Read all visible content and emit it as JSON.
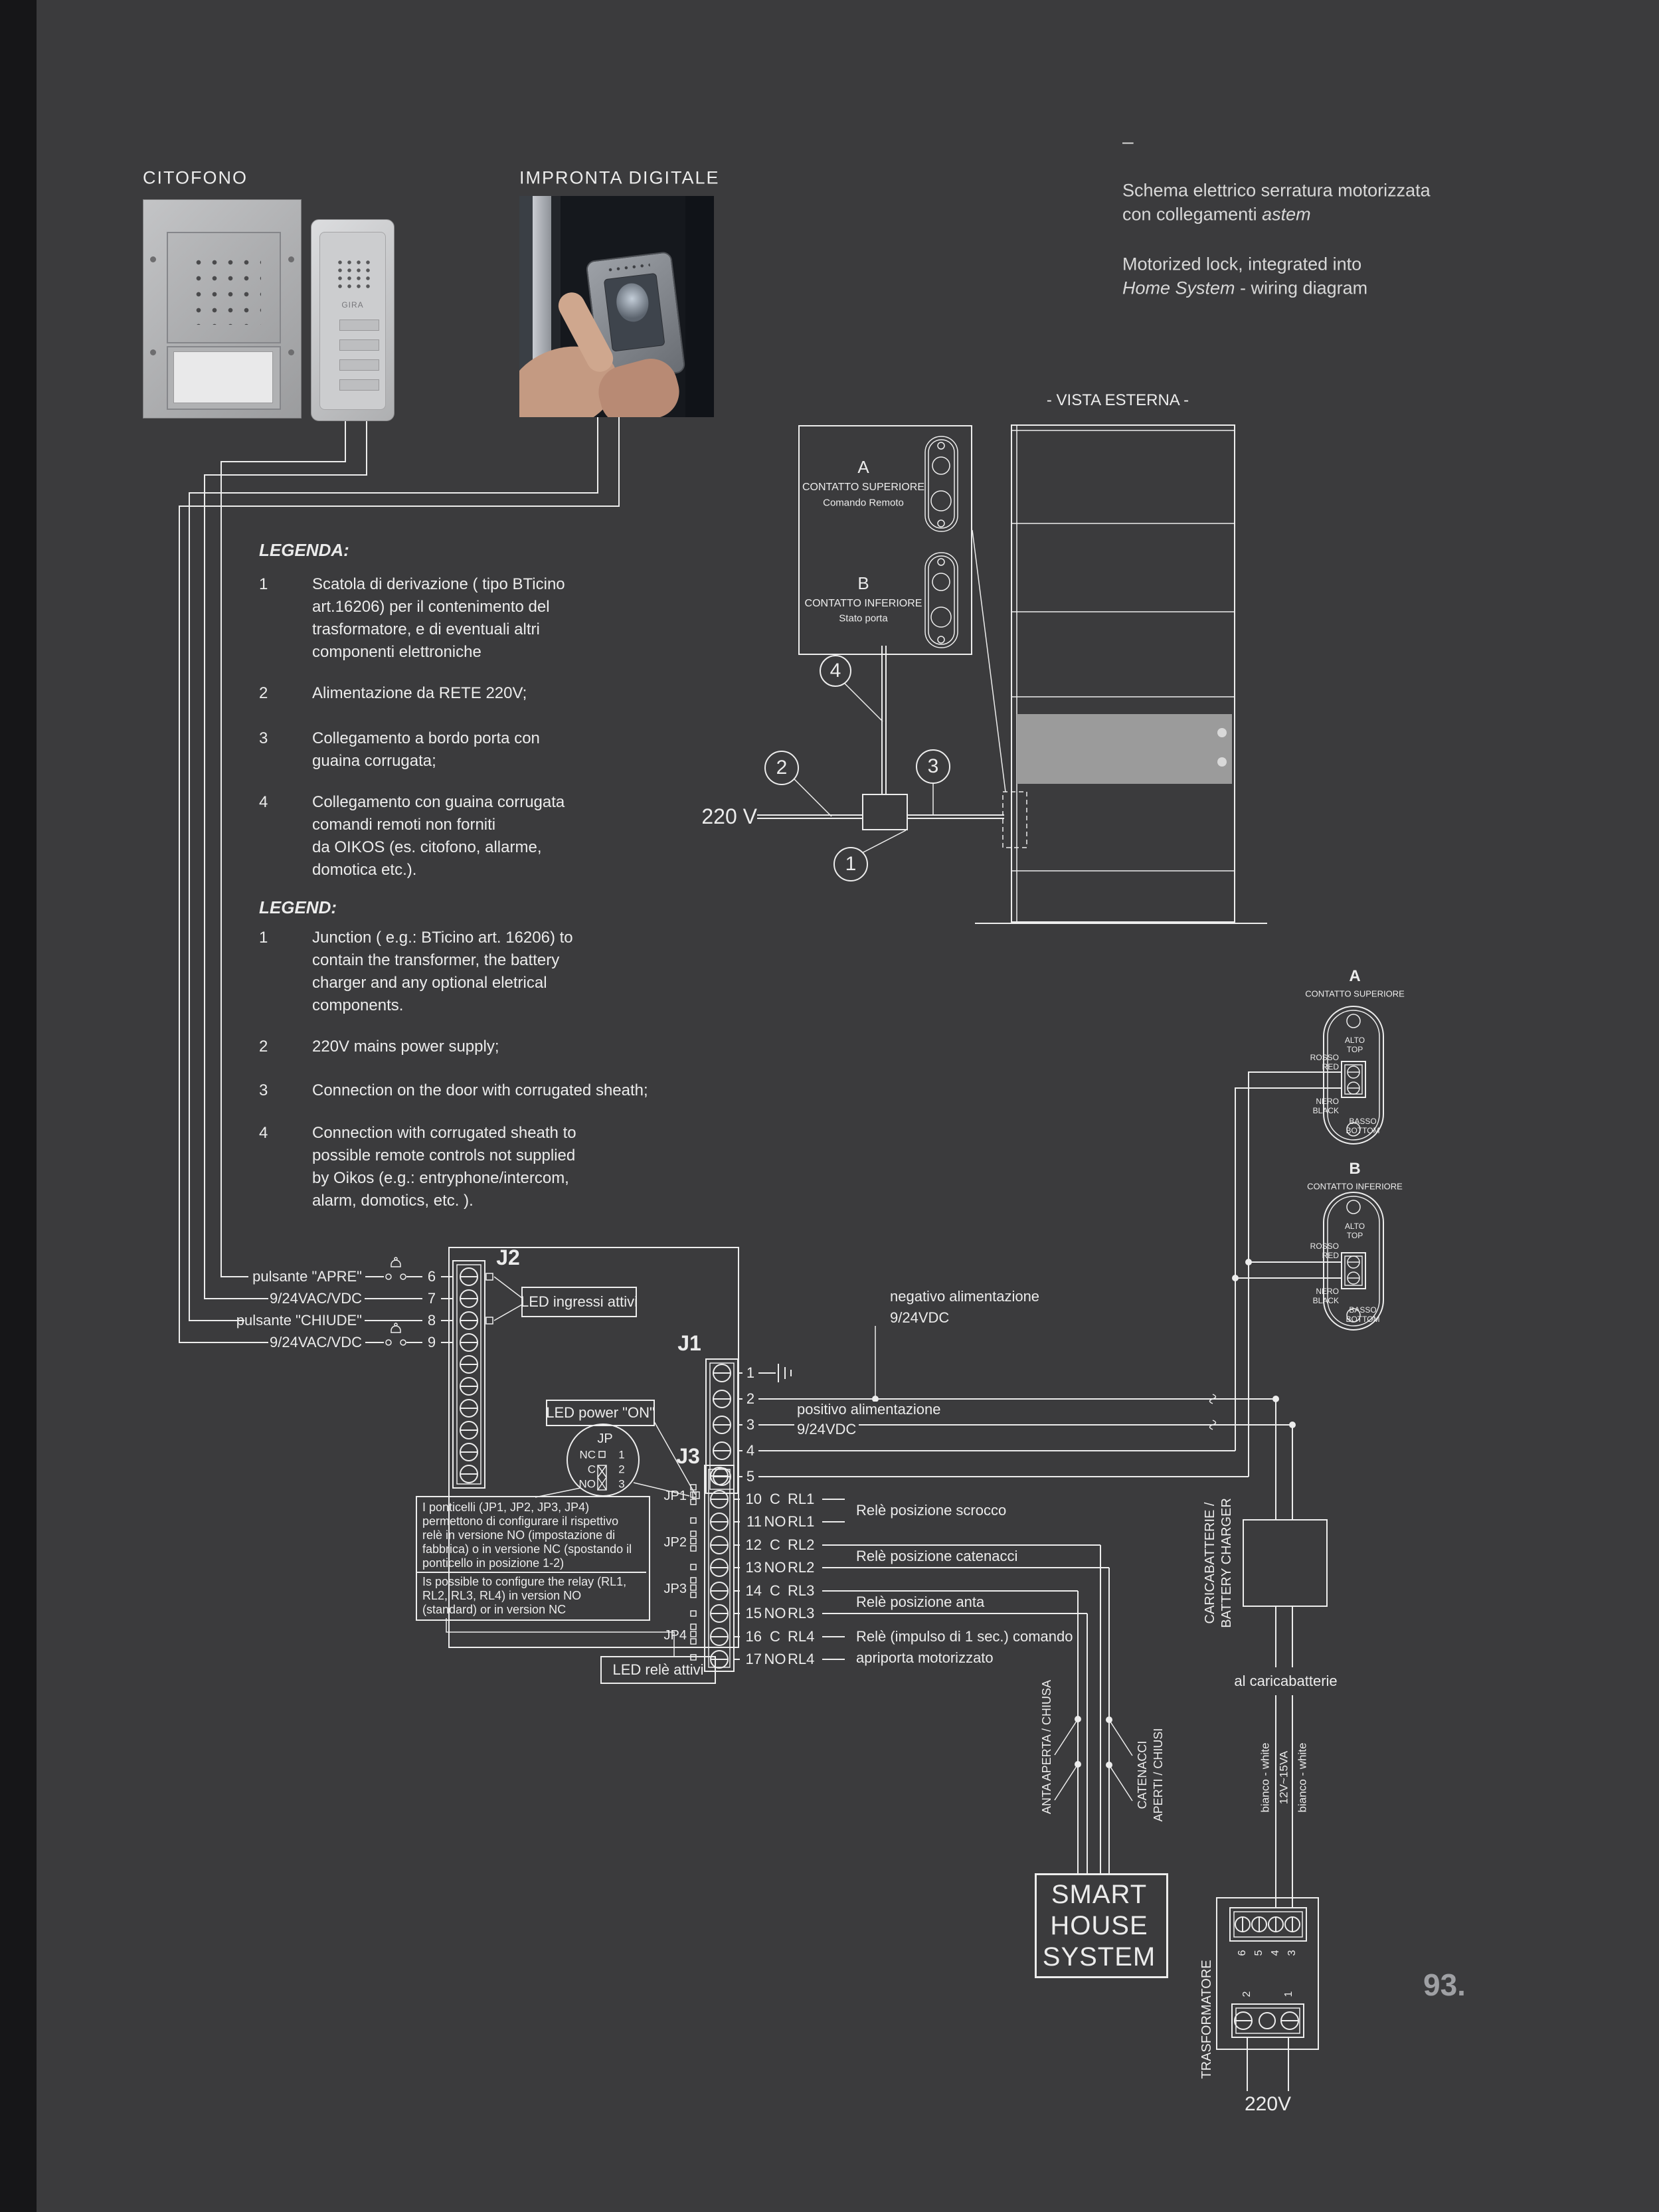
{
  "page": {
    "number": "93."
  },
  "header": {
    "left_label": "CITOFONO",
    "mid_label": "IMPRONTA DIGITALE",
    "dash": "–",
    "title_it_1": "Schema elettrico serratura motorizzata",
    "title_it_2a": "con collegamenti ",
    "title_it_2b": "astem",
    "title_en_1": "Motorized lock, integrated into",
    "title_en_2a": "Home System",
    "title_en_2b": " - wiring diagram"
  },
  "photos": {
    "handset_brand": "GIRA"
  },
  "vista": {
    "label": "- VISTA ESTERNA -",
    "v220": "220 V",
    "callout_1": "1",
    "callout_2": "2",
    "callout_3": "3",
    "callout_4": "4"
  },
  "contact_legend": {
    "a_letter": "A",
    "a_title": "CONTATTO SUPERIORE",
    "a_sub": "Comando Remoto",
    "b_letter": "B",
    "b_title": "CONTATTO INFERIORE",
    "b_sub": "Stato porta"
  },
  "legenda": {
    "title": "LEGENDA:",
    "items": [
      {
        "n": "1",
        "lines": [
          "Scatola di derivazione ( tipo BTicino",
          "art.16206) per il contenimento del",
          "trasformatore, e di eventuali altri",
          "componenti elettroniche"
        ]
      },
      {
        "n": "2",
        "lines": [
          "Alimentazione da RETE 220V;"
        ]
      },
      {
        "n": "3",
        "lines": [
          "Collegamento a bordo porta con",
          "guaina corrugata;"
        ]
      },
      {
        "n": "4",
        "lines": [
          "Collegamento con guaina corrugata",
          "comandi remoti non forniti",
          "da OIKOS (es. citofono, allarme,",
          "domotica etc.)."
        ]
      }
    ]
  },
  "legend": {
    "title": "LEGEND:",
    "items": [
      {
        "n": "1",
        "lines": [
          "Junction ( e.g.: BTicino art. 16206) to",
          "contain the transformer, the battery",
          "charger and any optional eletrical",
          "components."
        ]
      },
      {
        "n": "2",
        "lines": [
          "220V mains power supply;"
        ]
      },
      {
        "n": "3",
        "lines": [
          "Connection on the door with corrugated sheath;"
        ]
      },
      {
        "n": "4",
        "lines": [
          "Connection with corrugated sheath to",
          "possible remote controls not supplied",
          "by Oikos (e.g.: entryphone/intercom,",
          "alarm, domotics, etc. )."
        ]
      }
    ]
  },
  "board": {
    "j2_label": "J2",
    "j1_label": "J1",
    "j3_label": "J3",
    "rows": [
      {
        "n": "6",
        "label": "pulsante \"APRE\""
      },
      {
        "n": "7",
        "label": "9/24VAC/VDC"
      },
      {
        "n": "8",
        "label": "pulsante \"CHIUDE\""
      },
      {
        "n": "9",
        "label": "9/24VAC/VDC"
      }
    ],
    "led_ingressi": "LED ingressi attivi",
    "led_power": "LED power \"ON\"",
    "led_rele": "LED relè attivi",
    "jp": {
      "title": "JP",
      "r1": "NC",
      "r2": "C",
      "r3": "NO",
      "p1": "1",
      "p2": "2",
      "p3": "3"
    },
    "j1_pins": [
      "1",
      "2",
      "3",
      "4",
      "5"
    ],
    "neg_label_1": "negativo alimentazione",
    "neg_label_2": "9/24VDC",
    "pos_label_1": "positivo alimentazione",
    "pos_label_2": "9/24VDC",
    "jp_labels": [
      "JP1",
      "JP2",
      "JP3",
      "JP4"
    ],
    "j3_rows": [
      {
        "n": "10",
        "c": "C",
        "rl": "RL1"
      },
      {
        "n": "11",
        "c": "NO",
        "rl": "RL1"
      },
      {
        "n": "12",
        "c": "C",
        "rl": "RL2"
      },
      {
        "n": "13",
        "c": "NO",
        "rl": "RL2"
      },
      {
        "n": "14",
        "c": "C",
        "rl": "RL3"
      },
      {
        "n": "15",
        "c": "NO",
        "rl": "RL3"
      },
      {
        "n": "16",
        "c": "C",
        "rl": "RL4"
      },
      {
        "n": "17",
        "c": "NO",
        "rl": "RL4"
      }
    ],
    "relay_label_1": "Relè posizione scrocco",
    "relay_label_2": "Relè posizione catenacci",
    "relay_label_3": "Relè posizione anta",
    "relay_label_4a": "Relè (impulso di 1 sec.) comando",
    "relay_label_4b": "apriporta motorizzato",
    "note_it": [
      "I ponticelli (JP1, JP2, JP3, JP4)",
      "permettono di configurare il rispettivo",
      "relè in versione NO (impostazione di",
      "fabbrica) o in versione NC (spostando il",
      "ponticello in posizione 1-2)"
    ],
    "note_en": [
      "Is possible to configure the relay (RL1,",
      "RL2, RL3, RL4) in version NO",
      "(standard) or in version NC"
    ]
  },
  "contacts": {
    "a_letter": "A",
    "a_title": "CONTATTO SUPERIORE",
    "b_letter": "B",
    "b_title": "CONTATTO INFERIORE",
    "alto": "ALTO",
    "top": "TOP",
    "rosso": "ROSSO",
    "red": "RED",
    "nero": "NERO",
    "black": "BLACK",
    "basso": "BASSO",
    "bottom": "BOTTOM"
  },
  "power": {
    "caricabatterie": "CARICABATTERIE /",
    "battery_charger": "BATTERY CHARGER",
    "al_caricabatterie": "al caricabatterie",
    "bianco_1": "bianco - white",
    "va": "12V~15VA",
    "bianco_2": "bianco - white",
    "anta": "ANTA APERTA / CHIUSA",
    "catenacci_1": "CATENACCI",
    "catenacci_2": "APERTI / CHIUSI",
    "smart_1": "SMART",
    "smart_2": "HOUSE",
    "smart_3": "SYSTEM",
    "trasformatore": "TRASFORMATORE",
    "t_top": [
      "6",
      "5",
      "4",
      "3"
    ],
    "t_bottom": [
      "2",
      "1"
    ],
    "v220": "220V"
  },
  "colors": {
    "background": "#3b3b3d",
    "line": "#ededed",
    "left_bar": "#161618",
    "door_band": "#9b9b9b",
    "page_number": "#9fa0a4"
  }
}
